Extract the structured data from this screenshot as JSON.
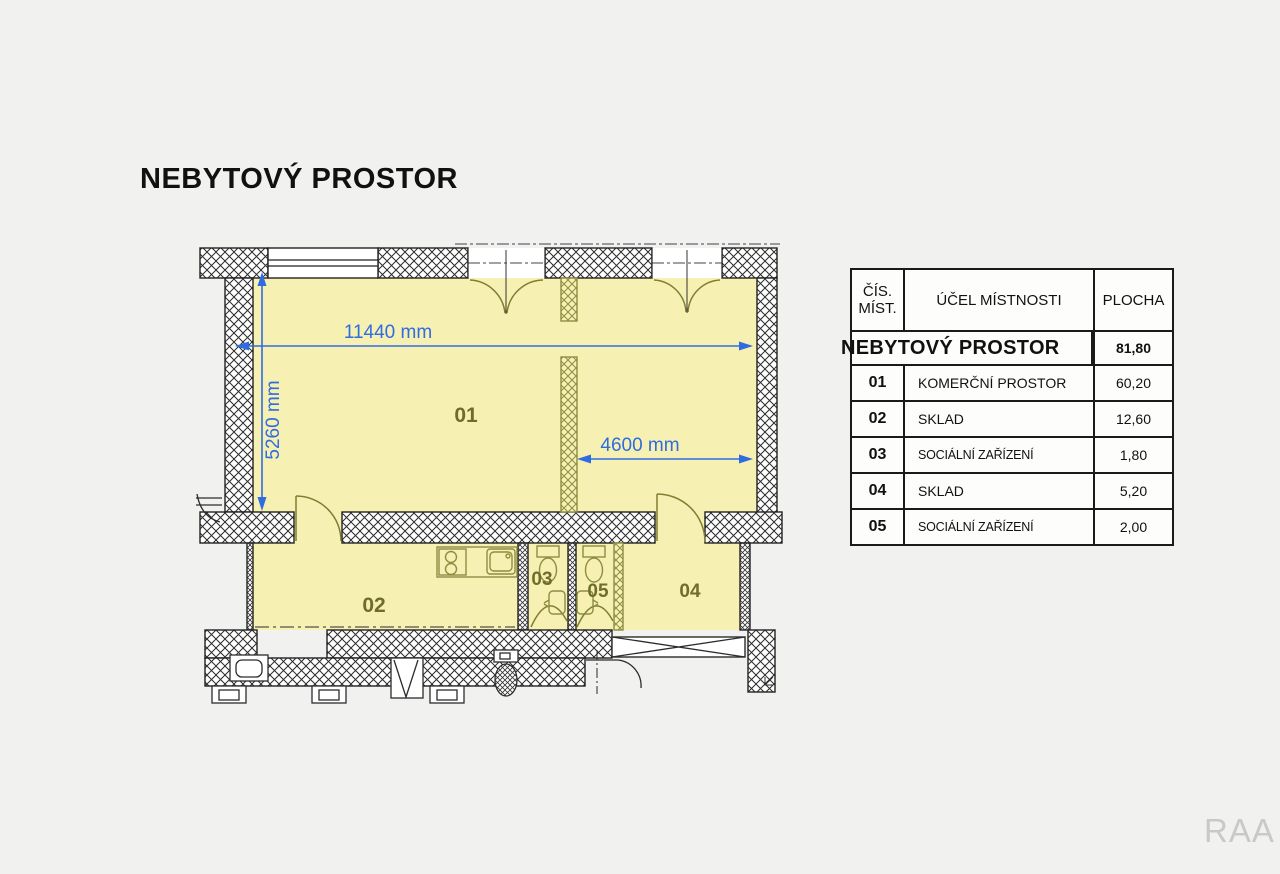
{
  "page": {
    "watermark": "RAA",
    "background_color": "#f1f1ef"
  },
  "title": "NEBYTOVÝ PROSTOR",
  "floor_plan": {
    "type": "architectural-floor-plan",
    "room_labels": {
      "r01": "01",
      "r02": "02",
      "r03": "03",
      "r04": "04",
      "r05": "05"
    },
    "dimensions": {
      "width_total": "11440 mm",
      "height_total": "5260 mm",
      "width_inner": "4600 mm"
    },
    "colors": {
      "room_fill": "#f6f0b2",
      "wall_line": "#222222",
      "partition_olive": "#8d8d42",
      "dimension_blue": "#2f6ce2",
      "room_label": "#6e6e2a"
    }
  },
  "table": {
    "header": {
      "col1_line1": "ČÍS.",
      "col1_line2": "MÍST.",
      "col2": "ÚČEL MÍSTNOSTI",
      "col3": "PLOCHA"
    },
    "total_row": {
      "label": "NEBYTOVÝ PROSTOR",
      "area": "81,80"
    },
    "rows": [
      {
        "num": "01",
        "purpose": "KOMERČNÍ PROSTOR",
        "area": "60,20"
      },
      {
        "num": "02",
        "purpose": "SKLAD",
        "area": "12,60"
      },
      {
        "num": "03",
        "purpose": "SOCIÁLNÍ ZAŘÍZENÍ",
        "area": "1,80"
      },
      {
        "num": "04",
        "purpose": "SKLAD",
        "area": "5,20"
      },
      {
        "num": "05",
        "purpose": "SOCIÁLNÍ ZAŘÍZENÍ",
        "area": "2,00"
      }
    ]
  }
}
